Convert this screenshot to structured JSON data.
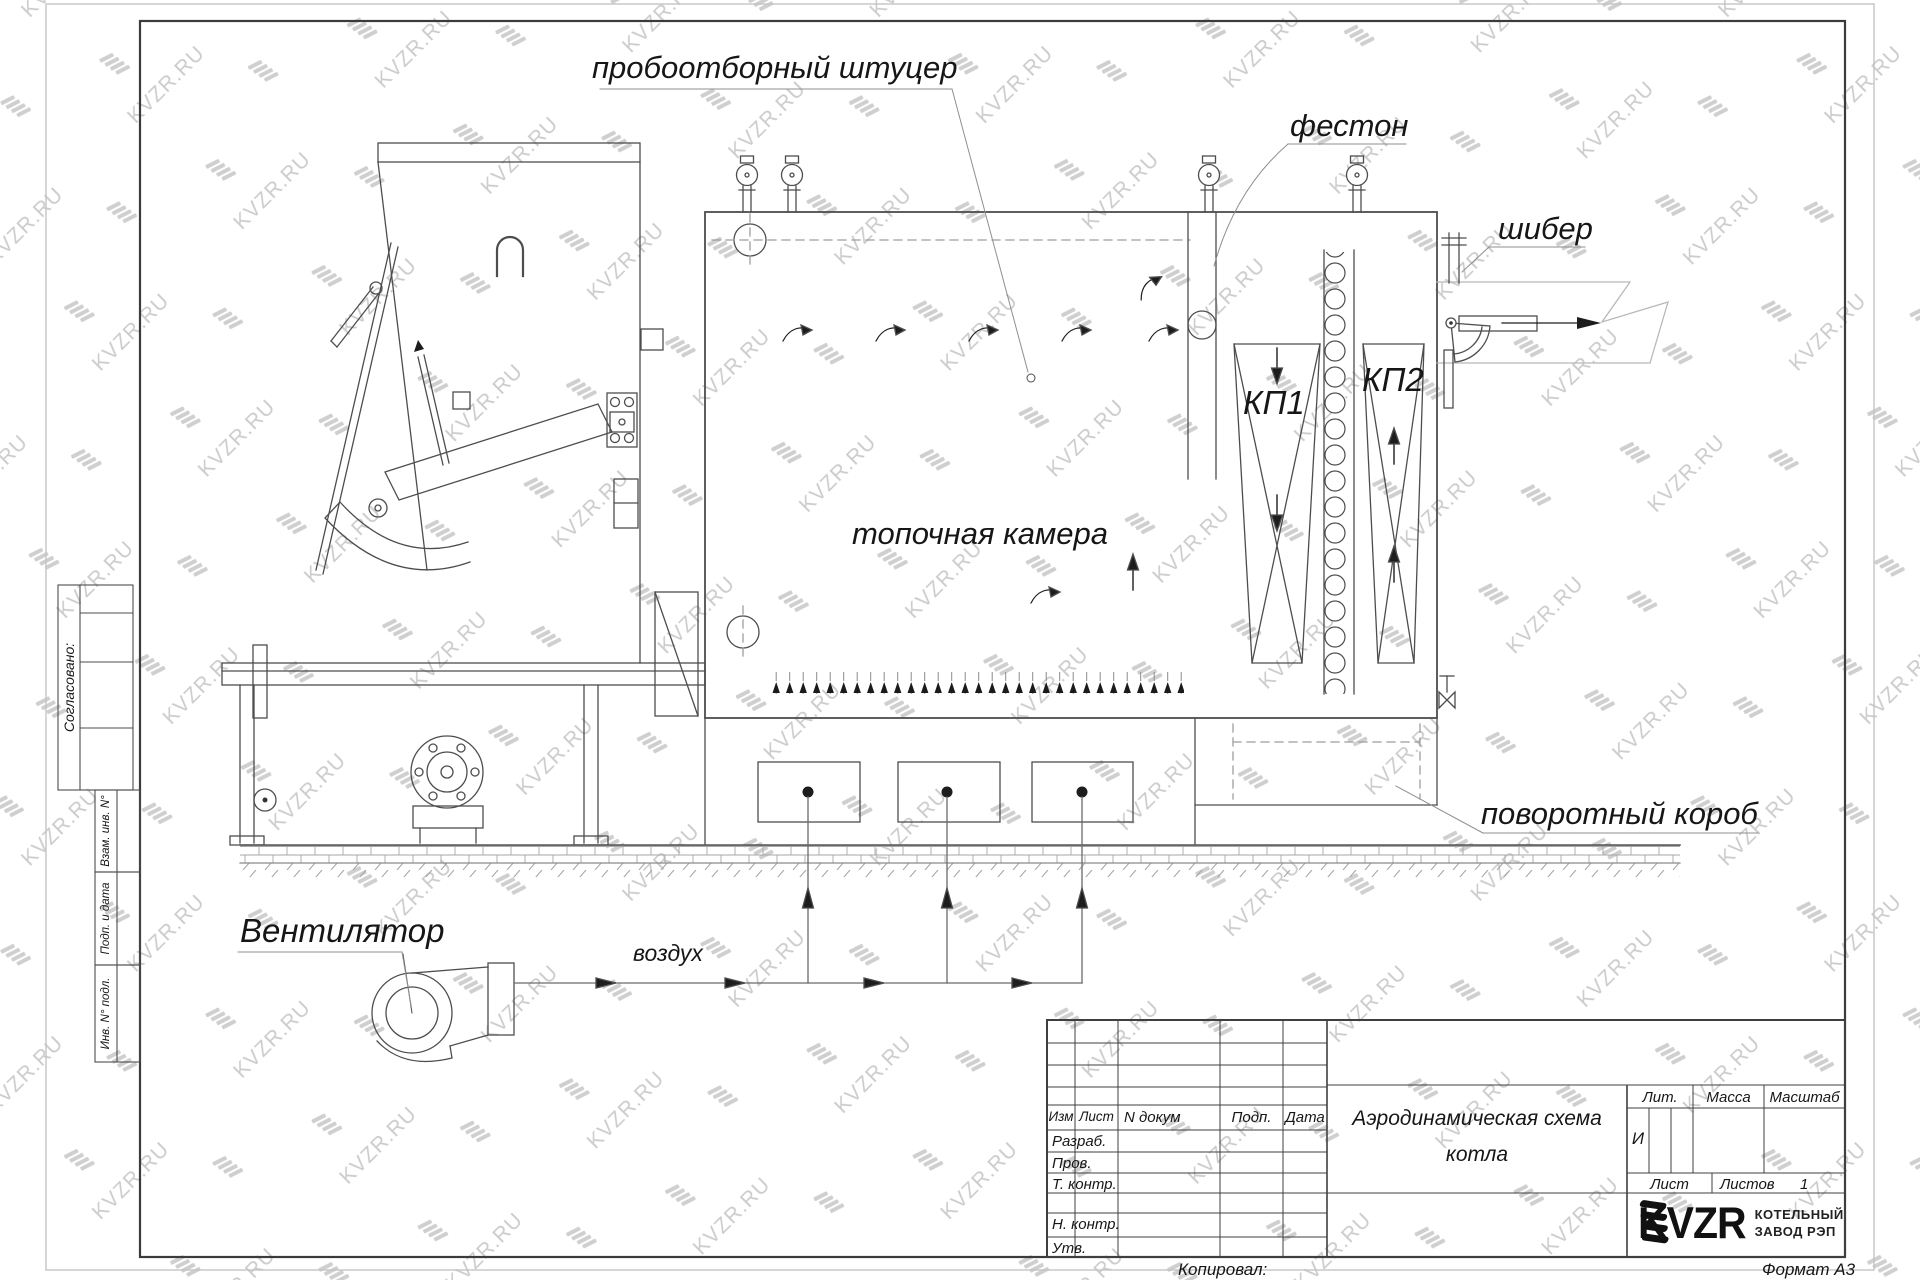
{
  "watermark": {
    "text": "KVZR.RU"
  },
  "diagram_labels": {
    "sampling_fitting": "пробоотборный штуцер",
    "festoon": "фестон",
    "damper": "шибер",
    "furnace": "топочная камера",
    "kp1": "КП1",
    "kp2": "КП2",
    "turning_duct": "поворотный короб",
    "fan": "Вентилятор",
    "air": "воздух"
  },
  "margin_labels": {
    "agreed": "Согласовано:",
    "zam_inv": "Взам. инв. N°",
    "sign_date": "Подп. и дата",
    "inv_orig": "Инв. N° подл."
  },
  "title_block": {
    "col_izm": "Изм",
    "col_list": "Лист",
    "col_ndoc": "N докум",
    "col_podp": "Подп.",
    "col_data": "Дата",
    "row_razrab": "Разраб.",
    "row_prov": "Пров.",
    "row_tkontr": "Т. контр.",
    "row_nkontr": "Н. контр.",
    "row_utv": "Утв.",
    "title_line1": "Аэродинамическая схема",
    "title_line2": "котла",
    "lit_label": "Лит.",
    "mass_label": "Масса",
    "scale_label": "Масштаб",
    "lit_value": "И",
    "sheet_label": "Лист",
    "sheets_label": "Листов",
    "sheets_value": "1",
    "brand": "KVZR",
    "company_line1": "КОТЕЛЬНЫЙ",
    "company_line2": "ЗАВОД РЭП",
    "copied": "Копировал:",
    "format": "Формат А3"
  }
}
